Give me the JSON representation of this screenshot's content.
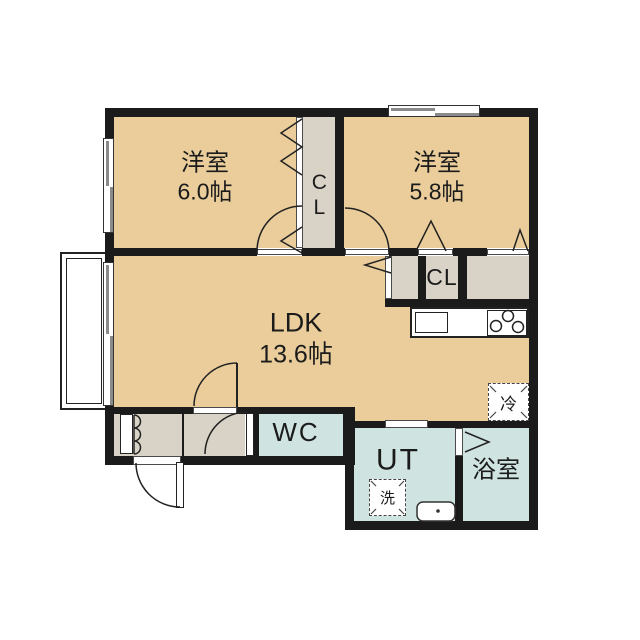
{
  "plan": {
    "type": "apartment-floor-plan",
    "colors": {
      "wall": "#1b1b1b",
      "room": "#eacd9b",
      "closet": "#d8d3c6",
      "wet": "#cfe3e0",
      "line": "#222222"
    },
    "rooms": {
      "west1": {
        "label": "洋室",
        "area": "6.0帖"
      },
      "west2": {
        "label": "洋室",
        "area": "5.8帖"
      },
      "ldk": {
        "label": "LDK",
        "area": "13.6帖"
      },
      "closet_top": {
        "label": "CL"
      },
      "closet_right": {
        "label": "CL"
      },
      "wc": {
        "label": "WC"
      },
      "ut": {
        "label": "UT"
      },
      "bath": {
        "label": "浴室"
      }
    },
    "fixtures": {
      "fridge": {
        "label": "冷"
      },
      "washer": {
        "label": "洗"
      },
      "kitchen": {
        "items": [
          "sink",
          "stove-3-burner"
        ]
      },
      "vanity-sink": {
        "present": true
      },
      "balcony": {
        "present": true
      },
      "shoe-cabinet": {
        "present": true
      }
    }
  }
}
